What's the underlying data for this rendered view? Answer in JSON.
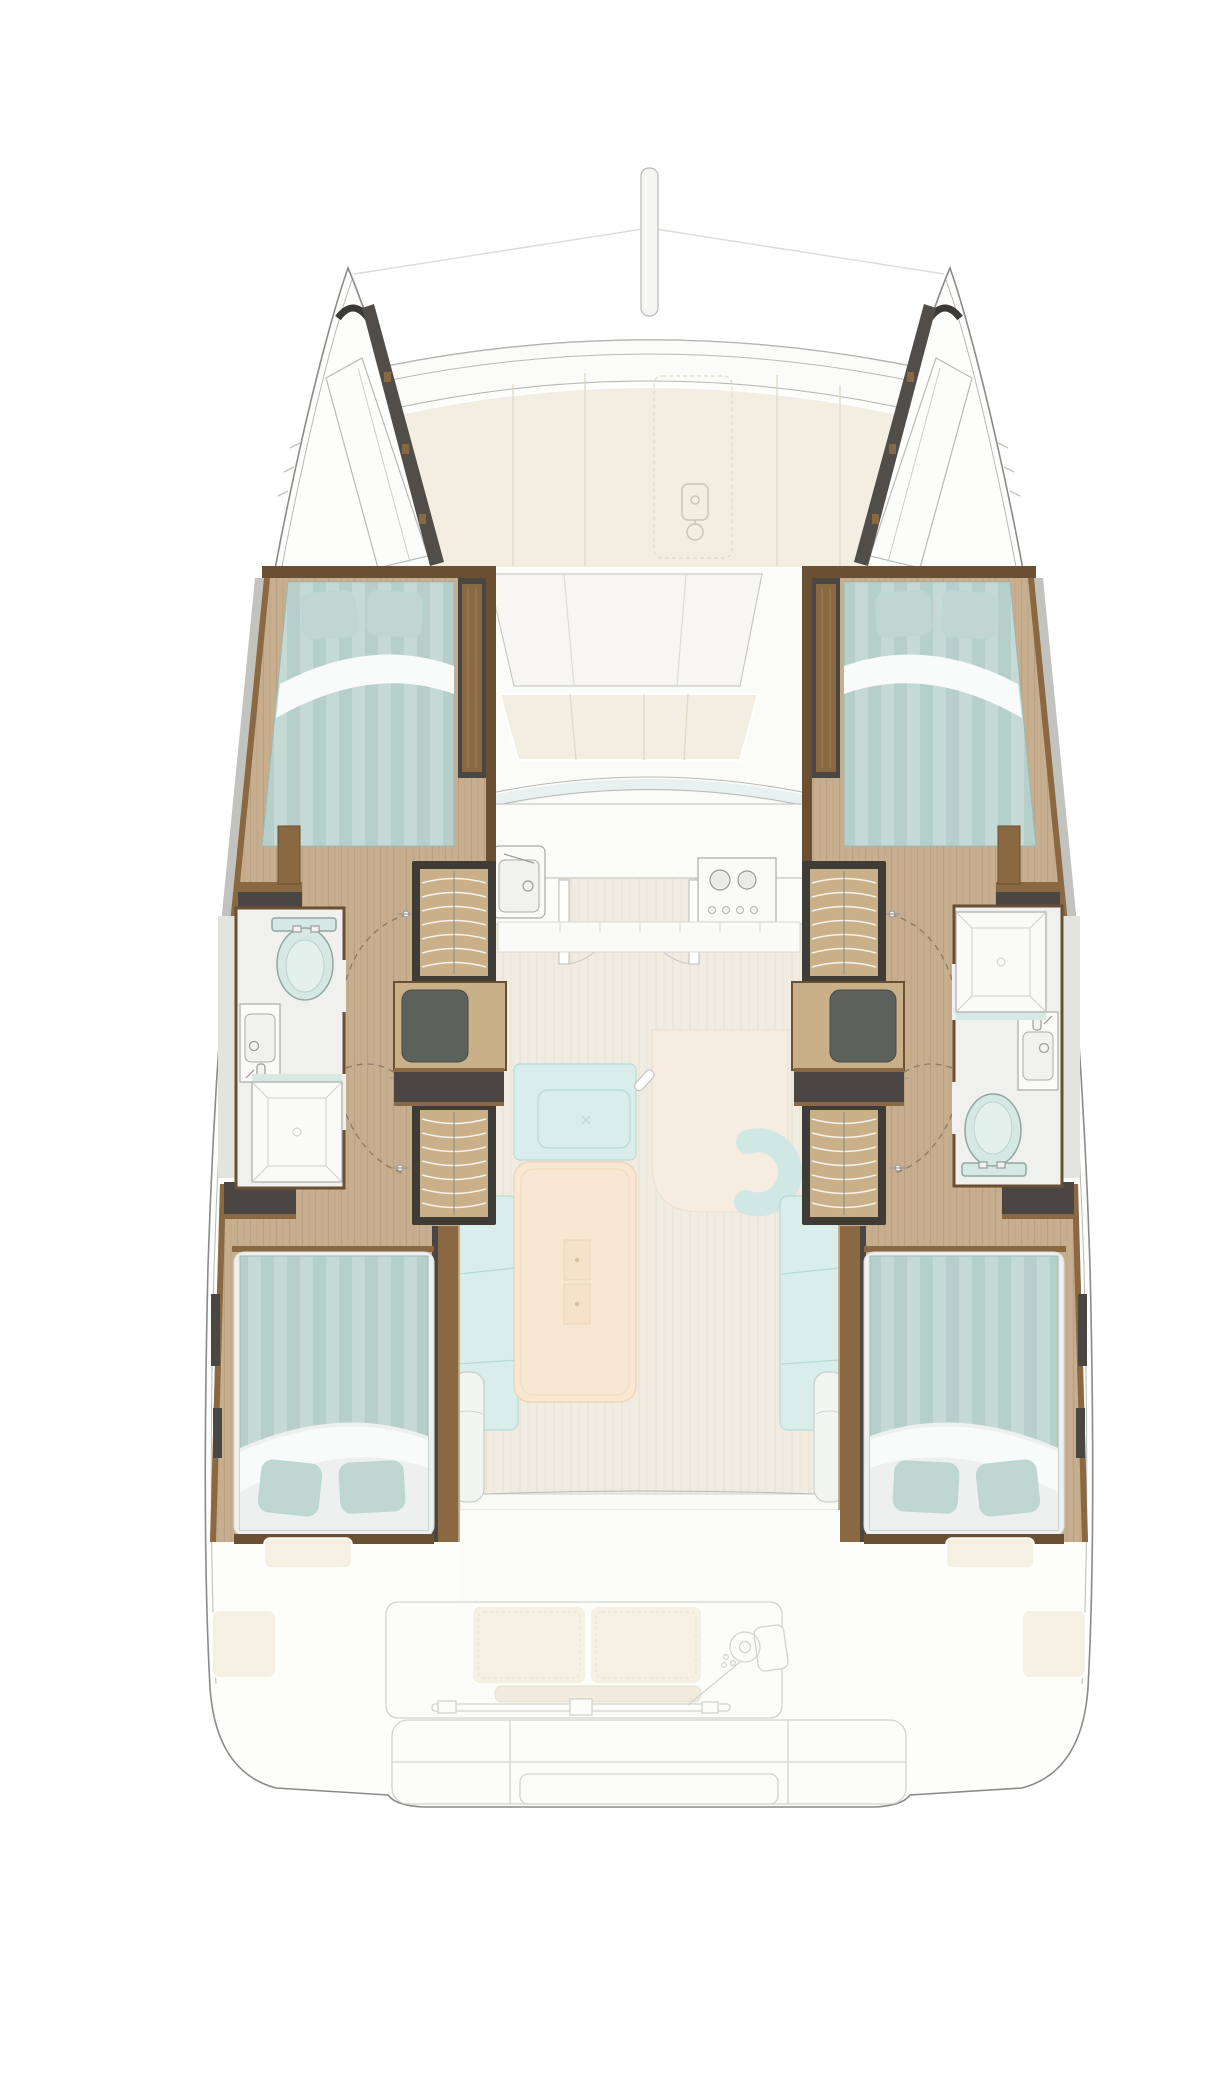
{
  "title": "Catamaran sailing yacht interior floor plan, top-down deck layout with four cabins, two heads, saloon and galley",
  "colors": {
    "page_bg": "#ffffff",
    "hull_fill": "#fdfdfc",
    "hull_line": "#8a8a88",
    "hull_line_light": "#b9b9b6",
    "ghost_line": "#d2d2cf",
    "deck_white": "#fbfbfa",
    "cream_cushion": "#f3eee1",
    "cream_seam": "#e0d9c6",
    "seat_white": "#f7f6f2",
    "wood_floor": "#c6ae8e",
    "wood_grain": "#b1967a",
    "saloon_floor": "#f1ece2",
    "saloon_grain": "#e4dccb",
    "wall_dark": "#4a4643",
    "trim_brown": "#8a6842",
    "trim_brown_dark": "#6b4f33",
    "step_frame": "#3f3c38",
    "step_wood": "#c9b089",
    "step_line": "#f5f2ec",
    "cabinet_panel": "#5d615b",
    "bed_base": "#b6cfca",
    "bed_stripe": "#c6dad5",
    "bed_edge": "#9db8b2",
    "pillow": "#bfd6d1",
    "blanket_white": "#f8fbfa",
    "mattress_white": "#edf0ee",
    "sofa": "#d9eeea",
    "sofa_seam": "#b9d8d2",
    "pouf": "#cfe8e4",
    "table": "#f8e7d2",
    "table_line": "#ecd5b8",
    "rug": "#f6ece0",
    "bath_floor": "#f0f0ee",
    "bath_wall": "#e3e3e0",
    "fixture_white": "#fafaf9",
    "fixture_line": "#aaaaa8",
    "toilet": "#d6e8e4",
    "toilet_line": "#8fa8a2",
    "glass_teal": "#d7e9e5",
    "stove_line": "#9a9a98",
    "door_arc": "#8a7a64",
    "hardware": "#9a9a98",
    "ghost_cream": "#f6f0e3",
    "ghost_fill": "#fcfcfb"
  },
  "areas": [
    {
      "id": "mast",
      "label": "mast"
    },
    {
      "id": "foredeck-sunpad",
      "label": "foredeck sunpad cushions"
    },
    {
      "id": "windlass",
      "label": "anchor windlass"
    },
    {
      "id": "bow-locker-port",
      "label": "port bow locker"
    },
    {
      "id": "bow-locker-starboard",
      "label": "starboard bow locker"
    },
    {
      "id": "forward-cockpit",
      "label": "forward cockpit seating"
    },
    {
      "id": "galley",
      "label": "galley with sink and stove"
    },
    {
      "id": "saloon",
      "label": "saloon with sofa and table"
    },
    {
      "id": "cabin-port-forward",
      "label": "port forward double cabin"
    },
    {
      "id": "cabin-starboard-forward",
      "label": "starboard forward double cabin"
    },
    {
      "id": "head-port",
      "label": "port bathroom with toilet, sink and shower"
    },
    {
      "id": "head-starboard",
      "label": "starboard bathroom with toilet, sink and shower"
    },
    {
      "id": "companionway-port",
      "label": "port hull companionway steps"
    },
    {
      "id": "companionway-starboard",
      "label": "starboard hull companionway steps"
    },
    {
      "id": "cabin-port-aft",
      "label": "port aft double cabin"
    },
    {
      "id": "cabin-starboard-aft",
      "label": "starboard aft double cabin"
    },
    {
      "id": "aft-cockpit",
      "label": "aft cockpit bench and helm"
    },
    {
      "id": "helm",
      "label": "helm steering wheel"
    },
    {
      "id": "transom",
      "label": "transom platform and steps"
    }
  ]
}
